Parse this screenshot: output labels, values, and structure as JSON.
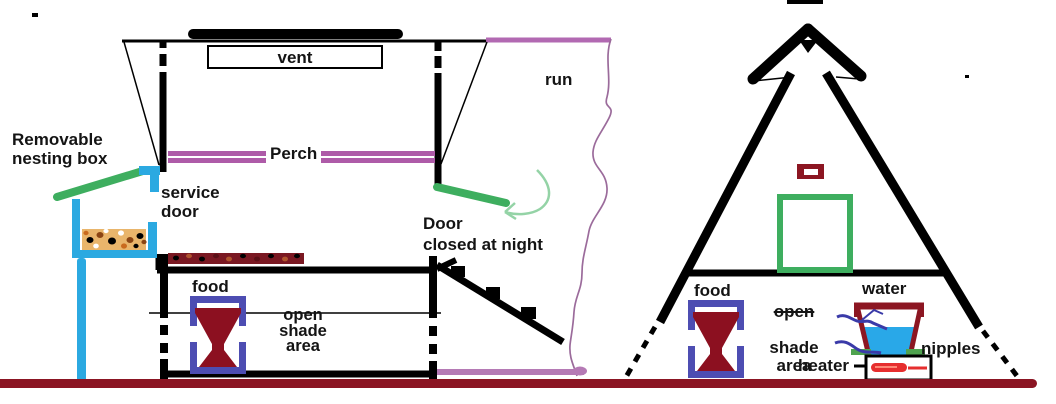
{
  "diagram_title": "chicken coop and A-frame run cross-section sketch",
  "colors": {
    "black": "#000000",
    "purple_perch": "#AE5BA8",
    "purple_run_top": "#B269B2",
    "purple_run_floor": "#B57AB5",
    "purple_wavy_fence": "#9B6B9B",
    "cyan_nesting_structure": "#2BA9E1",
    "green_roof_and_door": "#3EAE5F",
    "green_pale_arrow": "#94D3A6",
    "green_nipples": "#4FA34F",
    "maroon_ground": "#8B1523",
    "maroon_feed": "#8C1020",
    "maroon_waterer": "#8C1622",
    "blue_feeder_outline": "#4D4DB2",
    "blue_water": "#29A8E8",
    "blue_tube": "#3A3AA8",
    "red_heater": "#E62E2E",
    "tan_nesting_material": "#E9B56B"
  },
  "left_coop": {
    "nesting_box_label": "Removable\nnesting box",
    "vent_label": "vent",
    "perch_label": "Perch",
    "service_door_label": "service\ndoor",
    "pop_door_label": "Door\nclosed at night",
    "food_label": "food",
    "shade_label": "open\nshade\narea",
    "run_label": "run"
  },
  "right_coop": {
    "food_label": "food",
    "shade_open_word": "open",
    "shade_rest_label": "shade\narea",
    "water_label": "water",
    "nipples_label": "nipples",
    "heater_label": "heater"
  }
}
